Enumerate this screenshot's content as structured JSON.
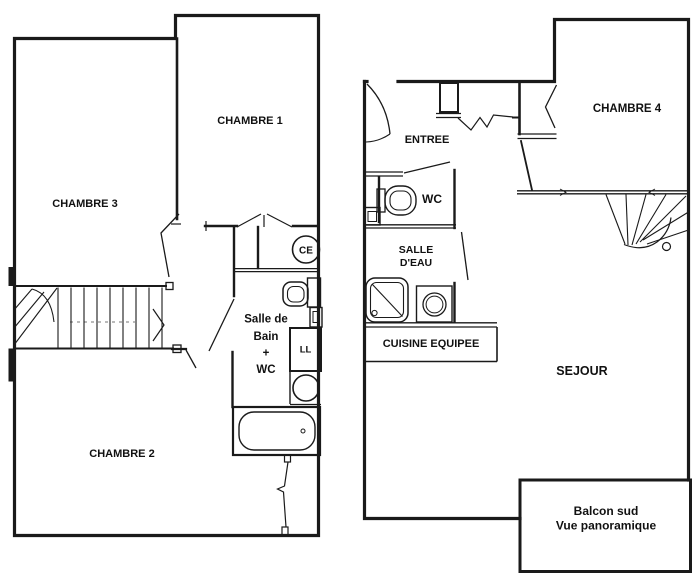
{
  "colors": {
    "background": "#ffffff",
    "line": "#1a1a1a"
  },
  "upper_floor": {
    "chambre1_label": "CHAMBRE 1",
    "chambre3_label": "CHAMBRE 3",
    "chambre2_label": "CHAMBRE 2",
    "ce_label": "CE",
    "bath_label_line1": "Salle de",
    "bath_label_line2": "Bain",
    "bath_label_line3": "+",
    "bath_label_line4": "WC",
    "ll_label": "LL"
  },
  "main_floor": {
    "entree_label": "ENTREE",
    "wc_label": "WC",
    "chambre4_label": "CHAMBRE 4",
    "salle_eau_label_line1": "SALLE",
    "salle_eau_label_line2": "D'EAU",
    "cuisine_label": "CUISINE EQUIPEE",
    "sejour_label": "SEJOUR",
    "balcon_label_line1": "Balcon sud",
    "balcon_label_line2": "Vue panoramique"
  }
}
